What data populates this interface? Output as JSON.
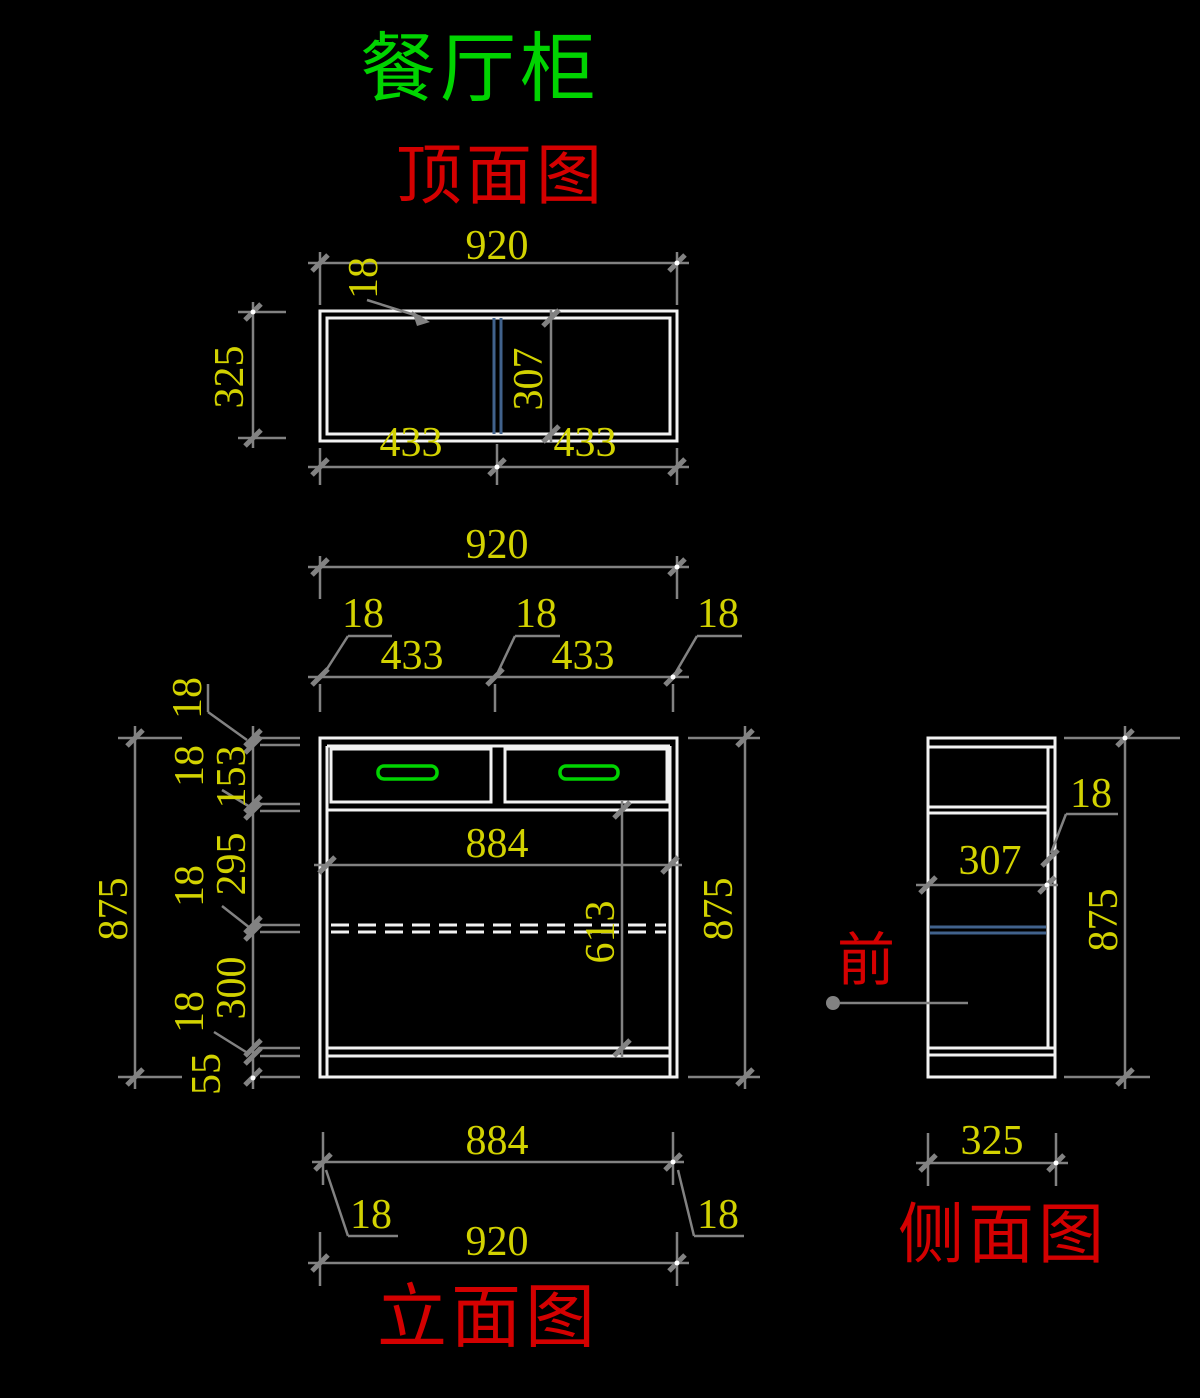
{
  "title": "餐厅柜",
  "colors": {
    "background": "#000000",
    "outline_white": "#f2f2f2",
    "dimension_gray": "#828282",
    "dim_text_yellow": "#d2d200",
    "label_red": "#d40000",
    "accent_green": "#00d400",
    "hidden_blue": "#41628c"
  },
  "top_view": {
    "label": "顶面图",
    "dim_width": "920",
    "dim_panel_thickness": "18",
    "dim_depth": "325",
    "dim_inner_depth": "307",
    "dim_left_half": "433",
    "dim_right_half": "433"
  },
  "front_view": {
    "label": "立面图",
    "dim_width_top": "920",
    "dim_wall_left": "18",
    "dim_divider": "18",
    "dim_wall_right": "18",
    "dim_bay_left": "433",
    "dim_bay_right": "433",
    "dim_top_panel": "18",
    "dim_drawer_height": "153",
    "dim_rail": "18",
    "dim_upper_space": "295",
    "dim_shelf": "18",
    "dim_lower_space": "300",
    "dim_bottom_panel": "18",
    "dim_plinth": "55",
    "dim_height_left": "875",
    "dim_height_right": "875",
    "dim_inner_width": "884",
    "dim_inner_height": "613",
    "dim_inner_width_bottom": "884",
    "dim_offset_left": "18",
    "dim_offset_right": "18",
    "dim_width_bottom": "920"
  },
  "side_view": {
    "label": "侧面图",
    "front_marker": "前",
    "dim_back_panel": "18",
    "dim_inner_depth": "307",
    "dim_height": "875",
    "dim_depth": "325"
  }
}
